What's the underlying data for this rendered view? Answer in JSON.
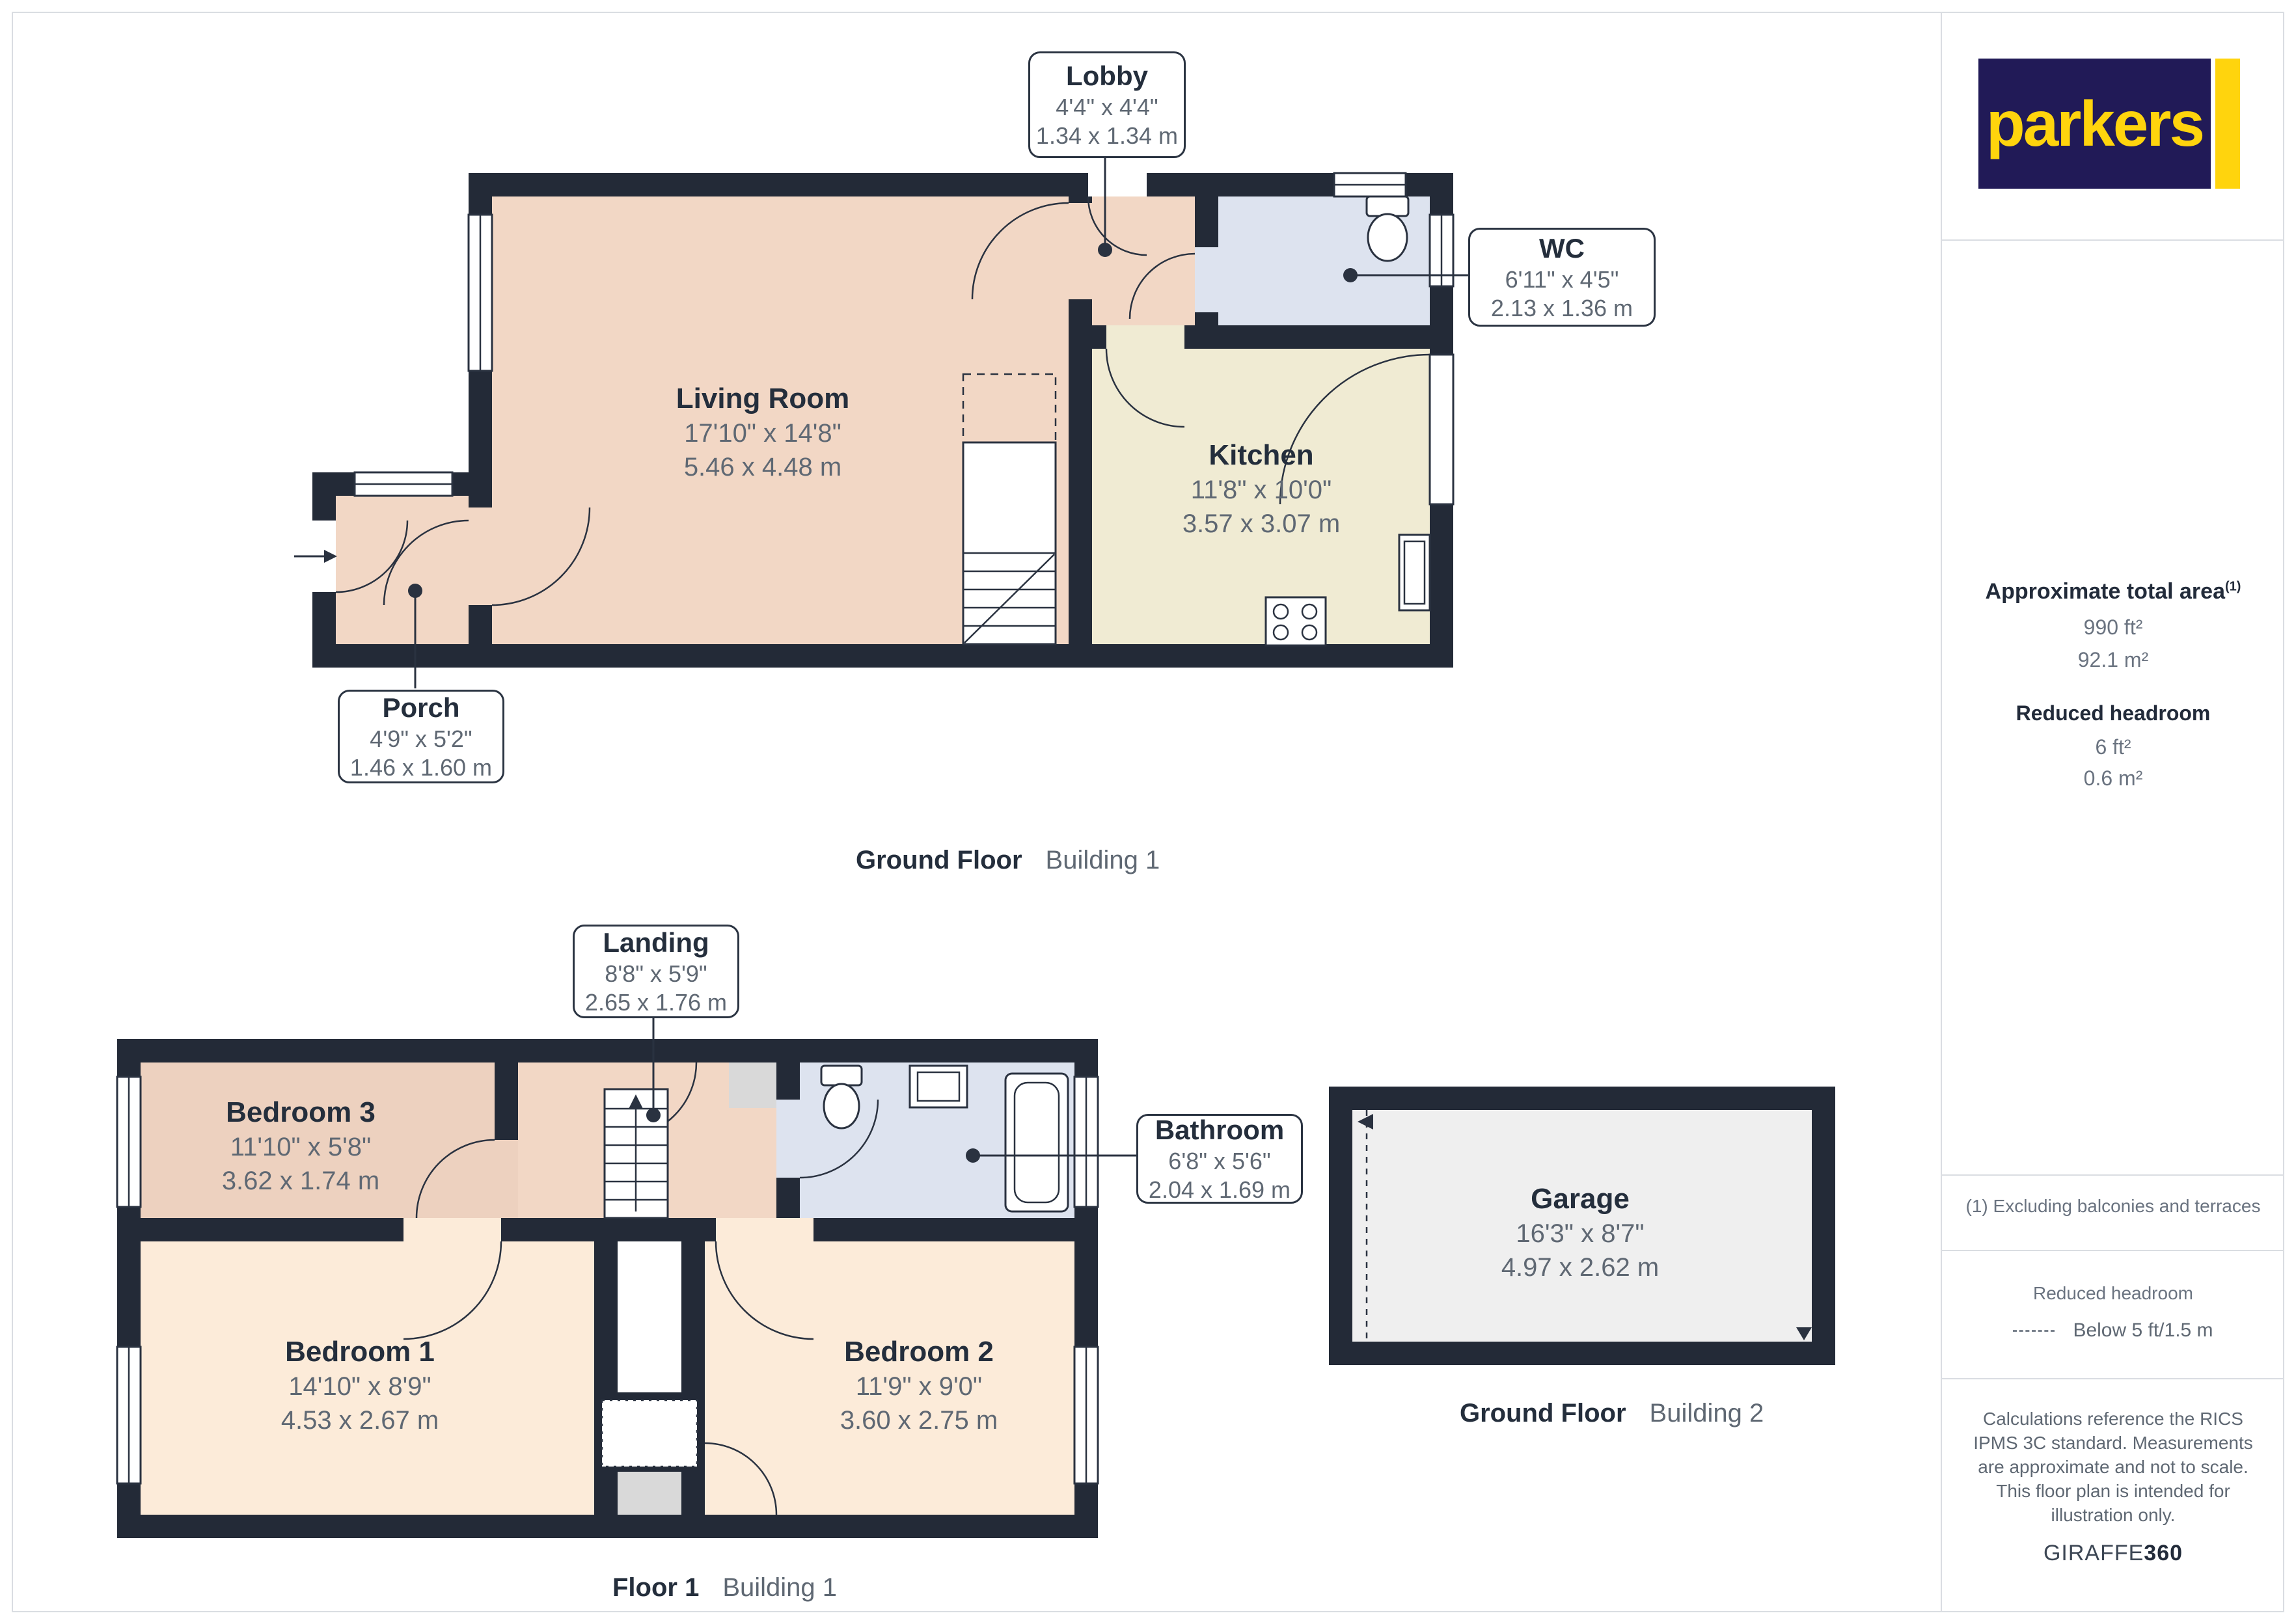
{
  "colors": {
    "wall": "#232a37",
    "line": "#2a3240",
    "salmon": "#f2d7c5",
    "salmon2": "#edd1bf",
    "cream": "#f0ebd3",
    "blue": "#dde3ef",
    "peach": "#fcebd9",
    "floor-gray": "#efefef",
    "cupboard-gray": "#d9d9d9",
    "brand-navy": "#211a57",
    "brand-yellow": "#ffd40d",
    "ink": "#242e3c",
    "muted": "#5f6873",
    "divider": "#dadde2"
  },
  "branding": {
    "logo_text": "parkers",
    "giraffe_prefix": "GIRAFFE",
    "giraffe_suffix": "360"
  },
  "sidebar": {
    "total_area": {
      "title": "Approximate total area",
      "superscript": "(1)",
      "imperial": "990 ft²",
      "metric": "92.1 m²"
    },
    "reduced_headroom": {
      "title": "Reduced headroom",
      "imperial": "6 ft²",
      "metric": "0.6 m²"
    },
    "footnote": "(1) Excluding balconies and terraces",
    "legend": {
      "title": "Reduced headroom",
      "label": "Below 5 ft/1.5 m"
    },
    "disclaimer": "Calculations reference the RICS IPMS 3C standard. Measurements are approximate and not to scale. This floor plan is intended for illustration only."
  },
  "captions": {
    "ground_floor_b1": {
      "bold": "Ground Floor",
      "regular": "Building 1"
    },
    "floor1_b1": {
      "bold": "Floor 1",
      "regular": "Building 1"
    },
    "ground_floor_b2": {
      "bold": "Ground Floor",
      "regular": "Building 2"
    }
  },
  "rooms": {
    "living_room": {
      "name": "Living Room",
      "imperial": "17'10\" x 14'8\"",
      "metric": "5.46 x 4.48 m"
    },
    "kitchen": {
      "name": "Kitchen",
      "imperial": "11'8\" x 10'0\"",
      "metric": "3.57 x 3.07 m"
    },
    "lobby": {
      "name": "Lobby",
      "imperial": "4'4\" x 4'4\"",
      "metric": "1.34 x 1.34 m"
    },
    "wc": {
      "name": "WC",
      "imperial": "6'11\" x 4'5\"",
      "metric": "2.13 x 1.36 m"
    },
    "porch": {
      "name": "Porch",
      "imperial": "4'9\" x 5'2\"",
      "metric": "1.46 x 1.60 m"
    },
    "landing": {
      "name": "Landing",
      "imperial": "8'8\" x 5'9\"",
      "metric": "2.65 x 1.76 m"
    },
    "bedroom1": {
      "name": "Bedroom 1",
      "imperial": "14'10\" x 8'9\"",
      "metric": "4.53 x 2.67 m"
    },
    "bedroom2": {
      "name": "Bedroom 2",
      "imperial": "11'9\" x 9'0\"",
      "metric": "3.60 x 2.75 m"
    },
    "bedroom3": {
      "name": "Bedroom 3",
      "imperial": "11'10\" x 5'8\"",
      "metric": "3.62 x 1.74 m"
    },
    "bathroom": {
      "name": "Bathroom",
      "imperial": "6'8\" x 5'6\"",
      "metric": "2.04 x 1.69 m"
    },
    "garage": {
      "name": "Garage",
      "imperial": "16'3\" x 8'7\"",
      "metric": "4.97 x 2.62 m"
    }
  }
}
